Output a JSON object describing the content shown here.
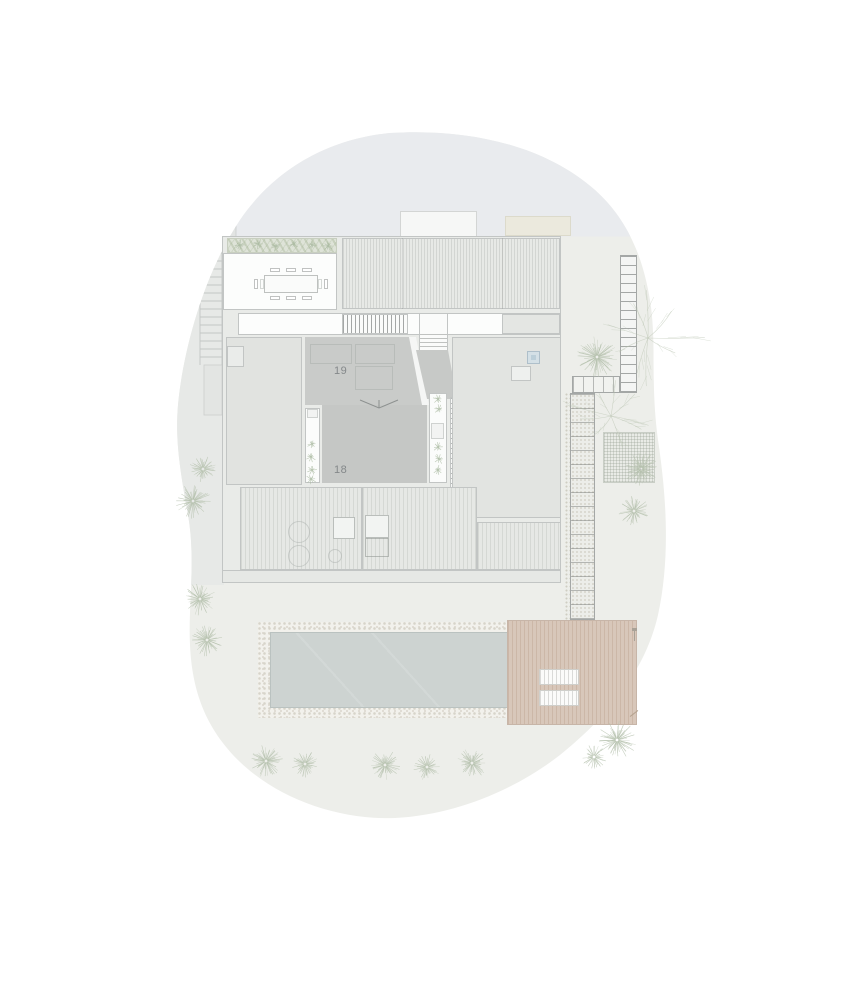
{
  "plan": {
    "labels": {
      "room_19": "19",
      "room_18": "18"
    }
  },
  "colors": {
    "page_bg": "#ffffff",
    "site_green": "#edeeea",
    "site_gray_top": "#e9ebee",
    "road": "#e7e9e7",
    "building_base": "#e9ebe8",
    "room_light": "#e1e3e0",
    "roof_19": "#c9cbc9",
    "roof_18": "#c5c7c5",
    "ramp": "#c7c9c7",
    "deck": "#e6e8e5",
    "outline": "#c2c5c4",
    "stair_line": "#a4a7a6",
    "water": "#cdd3d1",
    "pebble": "#f2f1ec",
    "pebble_dot": "#d7d4ca",
    "wood": "#d8c7ba",
    "plant_green": "#a9b9a0",
    "tree_stroke": "#b4c0ac",
    "skylight_blue": "#d4e0e6",
    "label_text": "#84888a"
  },
  "vegetation": {
    "palms": [
      {
        "x": 203,
        "y": 469,
        "r": 13
      },
      {
        "x": 193,
        "y": 501,
        "r": 17
      },
      {
        "x": 200,
        "y": 599,
        "r": 16
      },
      {
        "x": 207,
        "y": 640,
        "r": 16
      },
      {
        "x": 597,
        "y": 357,
        "r": 20
      },
      {
        "x": 641,
        "y": 469,
        "r": 17
      },
      {
        "x": 634,
        "y": 511,
        "r": 15
      },
      {
        "x": 266,
        "y": 761,
        "r": 16
      },
      {
        "x": 305,
        "y": 764,
        "r": 13
      },
      {
        "x": 385,
        "y": 765,
        "r": 15
      },
      {
        "x": 427,
        "y": 767,
        "r": 13
      },
      {
        "x": 472,
        "y": 763,
        "r": 15
      },
      {
        "x": 594,
        "y": 757,
        "r": 12
      },
      {
        "x": 617,
        "y": 740,
        "r": 19
      }
    ],
    "branch_trees": [
      {
        "x": 648,
        "y": 338,
        "r": 55
      },
      {
        "x": 611,
        "y": 416,
        "r": 46
      }
    ],
    "shrubs": [
      {
        "x": 312,
        "y": 444
      },
      {
        "x": 311,
        "y": 457
      },
      {
        "x": 312,
        "y": 470
      },
      {
        "x": 311,
        "y": 479
      },
      {
        "x": 438,
        "y": 399
      },
      {
        "x": 439,
        "y": 409
      },
      {
        "x": 438,
        "y": 447
      },
      {
        "x": 439,
        "y": 459
      },
      {
        "x": 438,
        "y": 470
      },
      {
        "x": 240,
        "y": 245
      },
      {
        "x": 258,
        "y": 244
      },
      {
        "x": 276,
        "y": 246
      },
      {
        "x": 294,
        "y": 244
      },
      {
        "x": 312,
        "y": 245
      },
      {
        "x": 328,
        "y": 246
      }
    ]
  }
}
